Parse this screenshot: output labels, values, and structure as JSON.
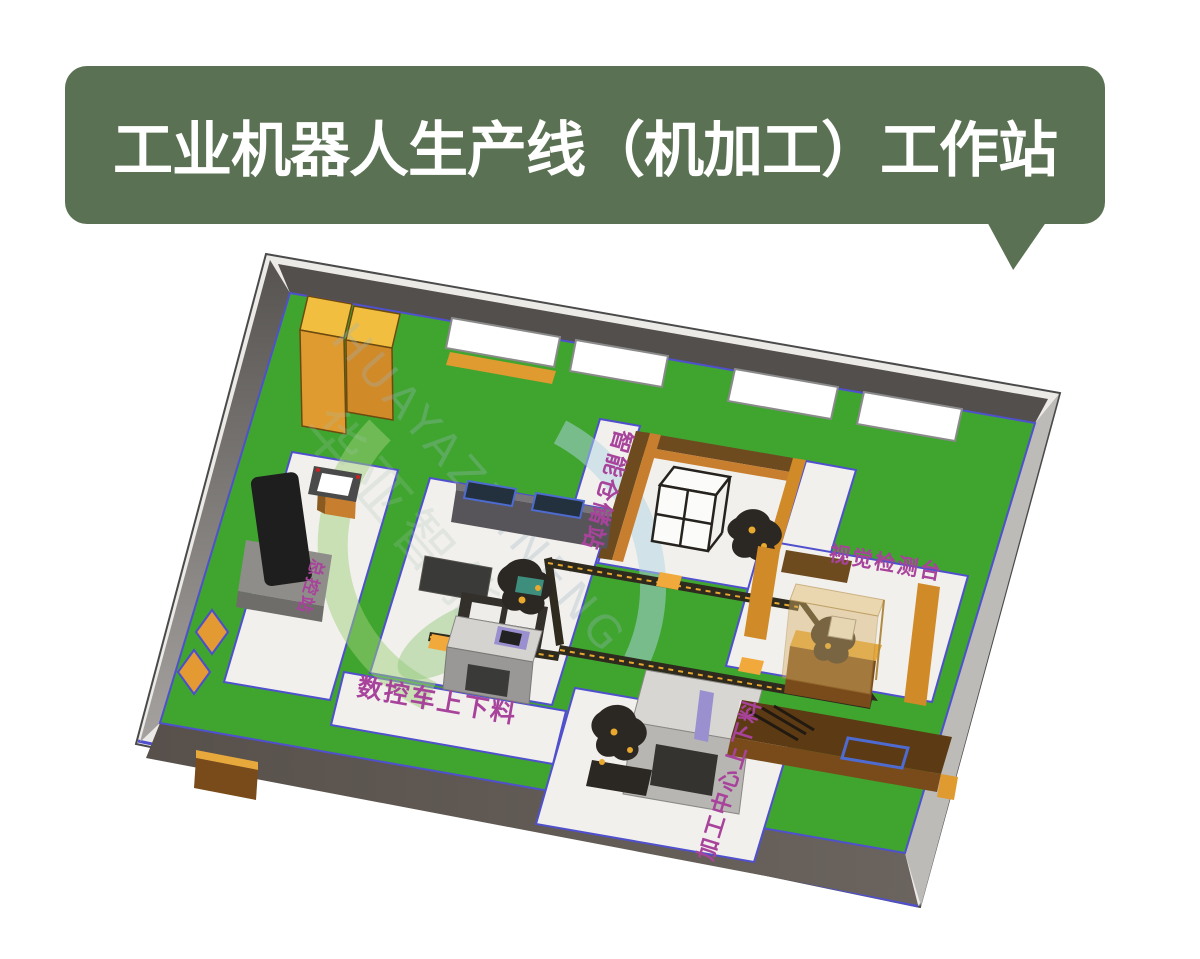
{
  "banner": {
    "title": "工业机器人生产线（机加工）工作站"
  },
  "scene": {
    "description": "isometric-3d-workshop-floorplan",
    "station_labels": {
      "storage": "智能仓储站",
      "inspection": "视觉检测台",
      "cnc_lathe": "数控车上下料",
      "machining_center": "加工中心上下料",
      "control": "总控站"
    },
    "watermark": {
      "latin": "HUAYAZHINENG",
      "cjk": "华亚智能"
    },
    "colors": {
      "banner_green": "#5A7153",
      "banner_text": "#FFFFFF",
      "floor_green": "#3FA52F",
      "walkway_white": "#F2F0ED",
      "walkway_border": "#5050CE",
      "wall_dark": "#524F4D",
      "wall_light": "#A9A7A4",
      "window_white": "#FFFFFF",
      "cabinet_orange": "#DF9A30",
      "cabinet_yellow_top": "#F2BE3F",
      "wood_brown": "#6E4A1F",
      "wood_orange": "#C87E2F",
      "glass_amber": "#D8B269",
      "conveyor_dark": "#2E2A1E",
      "conveyor_yellow": "#F2A93B",
      "label_purple": "#A8439B",
      "machine_gray": "#D5D3D0",
      "robot_dark": "#2B2722",
      "robot_yellow": "#E8A92E",
      "lavender": "#9A90CF",
      "watermark_green": "#9FCF7B",
      "watermark_blue": "#AFD4E6"
    }
  }
}
